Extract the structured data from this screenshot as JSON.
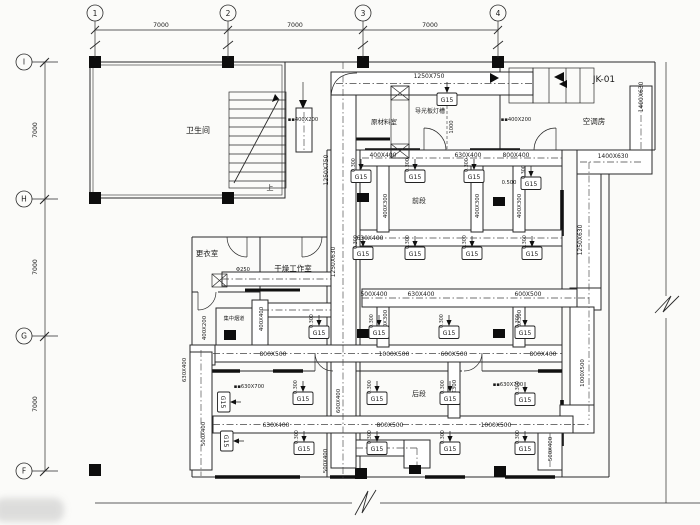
{
  "drawing": {
    "unit_tag": "JK-01",
    "stair_up_label": "上",
    "diffuser_tag": "G15",
    "elevation_tag": "0.300"
  },
  "grid": {
    "top": [
      {
        "label": "1",
        "x": 95
      },
      {
        "label": "2",
        "x": 228
      },
      {
        "label": "3",
        "x": 363
      },
      {
        "label": "4",
        "x": 498
      }
    ],
    "top_dims": [
      {
        "text": "7000",
        "x": 161
      },
      {
        "text": "7000",
        "x": 295
      },
      {
        "text": "7000",
        "x": 430
      }
    ],
    "left": [
      {
        "label": "I",
        "y": 62
      },
      {
        "label": "H",
        "y": 199
      },
      {
        "label": "G",
        "y": 336
      },
      {
        "label": "F",
        "y": 471
      }
    ],
    "left_dims": [
      {
        "text": "7000",
        "y": 130
      },
      {
        "text": "7000",
        "y": 267
      },
      {
        "text": "7000",
        "y": 404
      }
    ]
  },
  "rooms": [
    {
      "name": "卫生间",
      "x": 198,
      "y": 133,
      "s": 8
    },
    {
      "name": "原材料室",
      "x": 384,
      "y": 124,
      "s": 6.5
    },
    {
      "name": "导光板灯槽",
      "x": 430,
      "y": 113,
      "s": 6
    },
    {
      "name": "空调房",
      "x": 594,
      "y": 124,
      "s": 7.5
    },
    {
      "name": "更衣室",
      "x": 207,
      "y": 256,
      "s": 7.5
    },
    {
      "name": "干燥工作室",
      "x": 293,
      "y": 271,
      "s": 7.5
    },
    {
      "name": "集中烟道",
      "x": 234,
      "y": 320,
      "s": 5.2
    },
    {
      "name": "前段",
      "x": 419,
      "y": 203,
      "s": 7
    },
    {
      "name": "后段",
      "x": 419,
      "y": 396,
      "s": 7
    }
  ],
  "duct_labels": [
    {
      "t": "1250X750",
      "x": 429,
      "y": 78
    },
    {
      "t": "▪▪400X200",
      "x": 303,
      "y": 121,
      "s": 5.2
    },
    {
      "t": "▪▪400X200",
      "x": 516,
      "y": 121,
      "s": 5.2
    },
    {
      "t": "400X400",
      "x": 383,
      "y": 157
    },
    {
      "t": "630X400",
      "x": 468,
      "y": 157
    },
    {
      "t": "800X400",
      "x": 516,
      "y": 157
    },
    {
      "t": "1400X630",
      "x": 613,
      "y": 158
    },
    {
      "t": "0.500",
      "x": 509,
      "y": 184,
      "s": 5.2
    },
    {
      "t": "630X400",
      "x": 370,
      "y": 240
    },
    {
      "t": "Φ250",
      "x": 243,
      "y": 271,
      "s": 5.2
    },
    {
      "t": "500X400",
      "x": 374,
      "y": 296
    },
    {
      "t": "630X400",
      "x": 421,
      "y": 296
    },
    {
      "t": "600X500",
      "x": 528,
      "y": 296
    },
    {
      "t": "800X500",
      "x": 273,
      "y": 356
    },
    {
      "t": "1000X500",
      "x": 394,
      "y": 356
    },
    {
      "t": "600X500",
      "x": 454,
      "y": 356
    },
    {
      "t": "800X400",
      "x": 543,
      "y": 356
    },
    {
      "t": "▪▪630X700",
      "x": 249,
      "y": 388,
      "s": 5.2
    },
    {
      "t": "▪▪630X700",
      "x": 508,
      "y": 386,
      "s": 5.2
    },
    {
      "t": "630X400",
      "x": 276,
      "y": 427
    },
    {
      "t": "800X500",
      "x": 390,
      "y": 427
    },
    {
      "t": "1000X500",
      "x": 496,
      "y": 427
    },
    {
      "t": "1250X750",
      "x": 328,
      "y": 170,
      "rot": true
    },
    {
      "t": "1250X630",
      "x": 335,
      "y": 262,
      "rot": true
    },
    {
      "t": "1250X630",
      "x": 582,
      "y": 240,
      "rot": true
    },
    {
      "t": "1400X630",
      "x": 643,
      "y": 97,
      "rot": true
    },
    {
      "t": "1000",
      "x": 453,
      "y": 127,
      "rot": true,
      "s": 5.2
    },
    {
      "t": "400X300",
      "x": 387,
      "y": 206,
      "rot": true,
      "s": 5.4
    },
    {
      "t": "400X300",
      "x": 479,
      "y": 206,
      "rot": true,
      "s": 5.4
    },
    {
      "t": "400X300",
      "x": 521,
      "y": 206,
      "rot": true,
      "s": 5.4
    },
    {
      "t": "400X300",
      "x": 387,
      "y": 322,
      "rot": true,
      "s": 5.4
    },
    {
      "t": "400X300",
      "x": 521,
      "y": 322,
      "rot": true,
      "s": 5.4
    },
    {
      "t": "400X300",
      "x": 456,
      "y": 392,
      "rot": true,
      "s": 5.4
    },
    {
      "t": "400X200",
      "x": 206,
      "y": 328,
      "rot": true,
      "s": 5.4
    },
    {
      "t": "400X400",
      "x": 263,
      "y": 319,
      "rot": true,
      "s": 5.4
    },
    {
      "t": "630X400",
      "x": 186,
      "y": 370,
      "rot": true,
      "s": 5.4
    },
    {
      "t": "500X400",
      "x": 205,
      "y": 434,
      "rot": true,
      "s": 5.4
    },
    {
      "t": "600X400",
      "x": 340,
      "y": 401,
      "rot": true,
      "s": 5.4
    },
    {
      "t": "500X400",
      "x": 327,
      "y": 461,
      "rot": true,
      "s": 5.4
    },
    {
      "t": "1000X500",
      "x": 584,
      "y": 373,
      "rot": true,
      "s": 5.4
    },
    {
      "t": "500X400",
      "x": 552,
      "y": 449,
      "rot": true,
      "s": 5.4
    }
  ],
  "diffusers": [
    {
      "x": 361,
      "y": 176
    },
    {
      "x": 415,
      "y": 176
    },
    {
      "x": 474,
      "y": 176
    },
    {
      "x": 531,
      "y": 183
    },
    {
      "x": 447,
      "y": 99,
      "elev": false
    },
    {
      "x": 363,
      "y": 253
    },
    {
      "x": 415,
      "y": 253
    },
    {
      "x": 472,
      "y": 253
    },
    {
      "x": 532,
      "y": 253
    },
    {
      "x": 319,
      "y": 332
    },
    {
      "x": 379,
      "y": 332
    },
    {
      "x": 449,
      "y": 332
    },
    {
      "x": 525,
      "y": 332
    },
    {
      "x": 303,
      "y": 398
    },
    {
      "x": 377,
      "y": 398
    },
    {
      "x": 450,
      "y": 398
    },
    {
      "x": 525,
      "y": 399
    },
    {
      "x": 304,
      "y": 448
    },
    {
      "x": 377,
      "y": 448
    },
    {
      "x": 450,
      "y": 448
    },
    {
      "x": 525,
      "y": 448
    },
    {
      "x": 224,
      "y": 402,
      "rot": true,
      "elev": false
    },
    {
      "x": 227,
      "y": 441,
      "rot": true,
      "elev": false
    }
  ]
}
